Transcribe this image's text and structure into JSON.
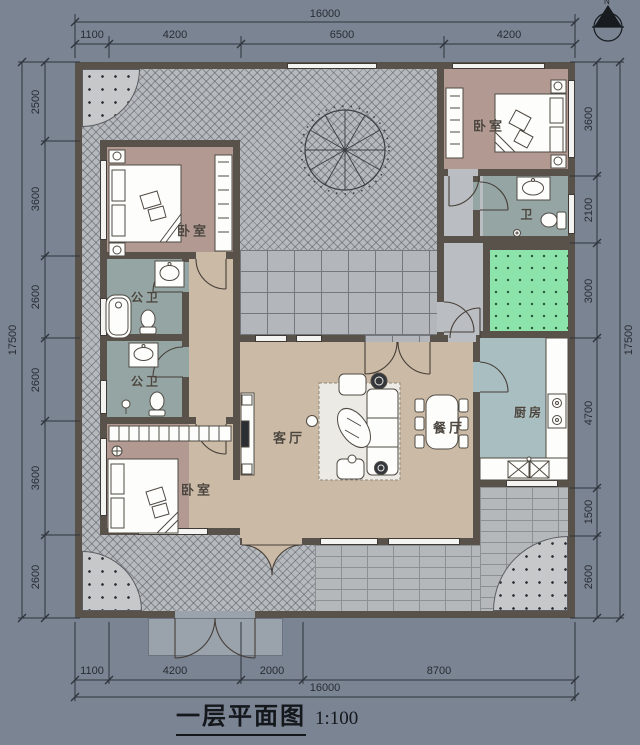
{
  "title": {
    "name": "一层平面图",
    "scale": "1:100"
  },
  "compass": {
    "north_label": "N"
  },
  "dimensions": {
    "top": {
      "overall": "16000",
      "segments": [
        "1100",
        "4200",
        "6500",
        "4200"
      ]
    },
    "bottom": {
      "overall": "16000",
      "segments": [
        "1100",
        "4200",
        "2000",
        "8700"
      ]
    },
    "left": {
      "overall": "17500",
      "segments": [
        "2500",
        "3600",
        "2600",
        "2600",
        "3600",
        "2600"
      ]
    },
    "right": {
      "overall": "17500",
      "segments": [
        "3600",
        "2100",
        "3000",
        "4700",
        "1500",
        "2600"
      ]
    }
  },
  "rooms": {
    "bedroom_top_right": {
      "label": "卧室"
    },
    "bath_top_right": {
      "label": "卫"
    },
    "bedroom_left_top": {
      "label": "卧室"
    },
    "bath_left_upper": {
      "label": "公卫"
    },
    "bath_left_lower": {
      "label": "公卫"
    },
    "bedroom_left_bottom": {
      "label": "卧室"
    },
    "living_room": {
      "label": "客厅"
    },
    "dining_room": {
      "label": "餐厅"
    },
    "kitchen": {
      "label": "厨房"
    }
  },
  "palette": {
    "background": "#7b8493",
    "wall": "#58524a",
    "bedroom_floor": "#b29a92",
    "bath_floor": "#94a5a4",
    "living_floor": "#cbbaa5",
    "kitchen_floor": "#a9bec1",
    "garden_green": "#8de4ab",
    "paving": "#b6b9bd",
    "dimension_ink": "#272d35"
  }
}
